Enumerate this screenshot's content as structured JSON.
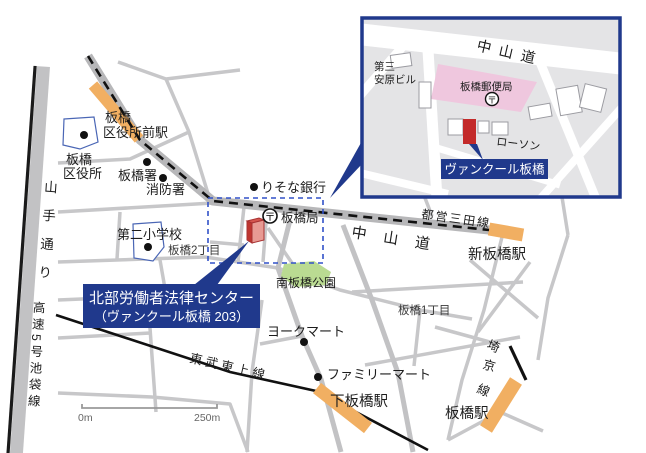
{
  "colors": {
    "navy": "#20398c",
    "selection_blue": "#3151c8",
    "station_orange": "#f1af62",
    "target_red": "#c32a2a",
    "park_green": "#badb92",
    "post_office_pink": "#efc7de"
  },
  "main_map": {
    "legal_center": {
      "line1": "北部労働者法律センター",
      "line2": "（ヴァンクール板橋 203）"
    },
    "stations": {
      "kuyakushomae_l1": "板橋",
      "kuyakushomae_l2": "区役所前駅",
      "shin_itabashi": "新板橋駅",
      "shimo_itabashi": "下板橋駅",
      "itabashi": "板橋駅"
    },
    "pois": {
      "ward_office_l1": "板橋",
      "ward_office_l2": "区役所",
      "police": "板橋署",
      "fire_station": "消防署",
      "resona_bank": "りそな銀行",
      "post_office": "板橋局",
      "school": "第二小学校",
      "park": "南板橋公園",
      "york_mart": "ヨークマート",
      "family_mart": "ファミリーマート"
    },
    "districts": {
      "itabashi_2chome": "板橋2丁目",
      "itabashi_1chome": "板橋1丁目"
    },
    "roads": {
      "nakasendo": "中山道",
      "yamate_dori": "山手通り",
      "expressway": "高速5号池袋線"
    },
    "railways": {
      "toei_mita": "都営三田線",
      "tobu_tojo": "東武東上線",
      "saikyo_1": "埼",
      "saikyo_2": "京",
      "saikyo_3": "線"
    },
    "scale": {
      "start": "0m",
      "end": "250m"
    },
    "post_symbol": "〒"
  },
  "inset": {
    "road": "中山道",
    "yasuhara_l1": "第三",
    "yasuhara_l2": "安原ビル",
    "post_office": "板橋郵便局",
    "lawson": "ローソン",
    "target": "ヴァンクール板橋",
    "post_symbol": "〒"
  }
}
